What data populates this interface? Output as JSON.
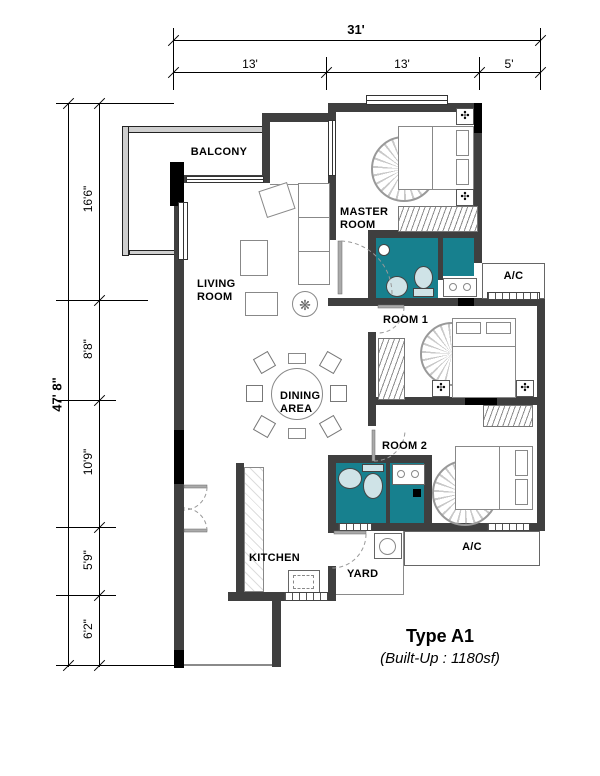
{
  "title": {
    "type": "Type A1",
    "builtup": "(Built-Up : 1180sf)"
  },
  "labels": {
    "balcony": "BALCONY",
    "living_room_line1": "LIVING",
    "living_room_line2": "ROOM",
    "master_room_line1": "MASTER",
    "master_room_line2": "ROOM",
    "dining_area_line1": "DINING",
    "dining_area_line2": "AREA",
    "room1": "ROOM 1",
    "room2": "ROOM 2",
    "kitchen": "KITCHEN",
    "yard": "YARD",
    "ac_top": "A/C",
    "ac_bottom": "A/C"
  },
  "dimensions": {
    "top_overall": "31'",
    "top_segments": [
      "13'",
      "13'",
      "5'"
    ],
    "left_overall": "47' 8\"",
    "left_segments": [
      "16'6\"",
      "8'8\"",
      "10'9\"",
      "5'9\"",
      "6'2\""
    ]
  },
  "icons": {
    "fan": "✣",
    "plant": "❋"
  },
  "colors": {
    "wall": "#3F3F3F",
    "pillar": "#000000",
    "wet_area": "#17808E",
    "fixture": "#CFE3E7"
  }
}
